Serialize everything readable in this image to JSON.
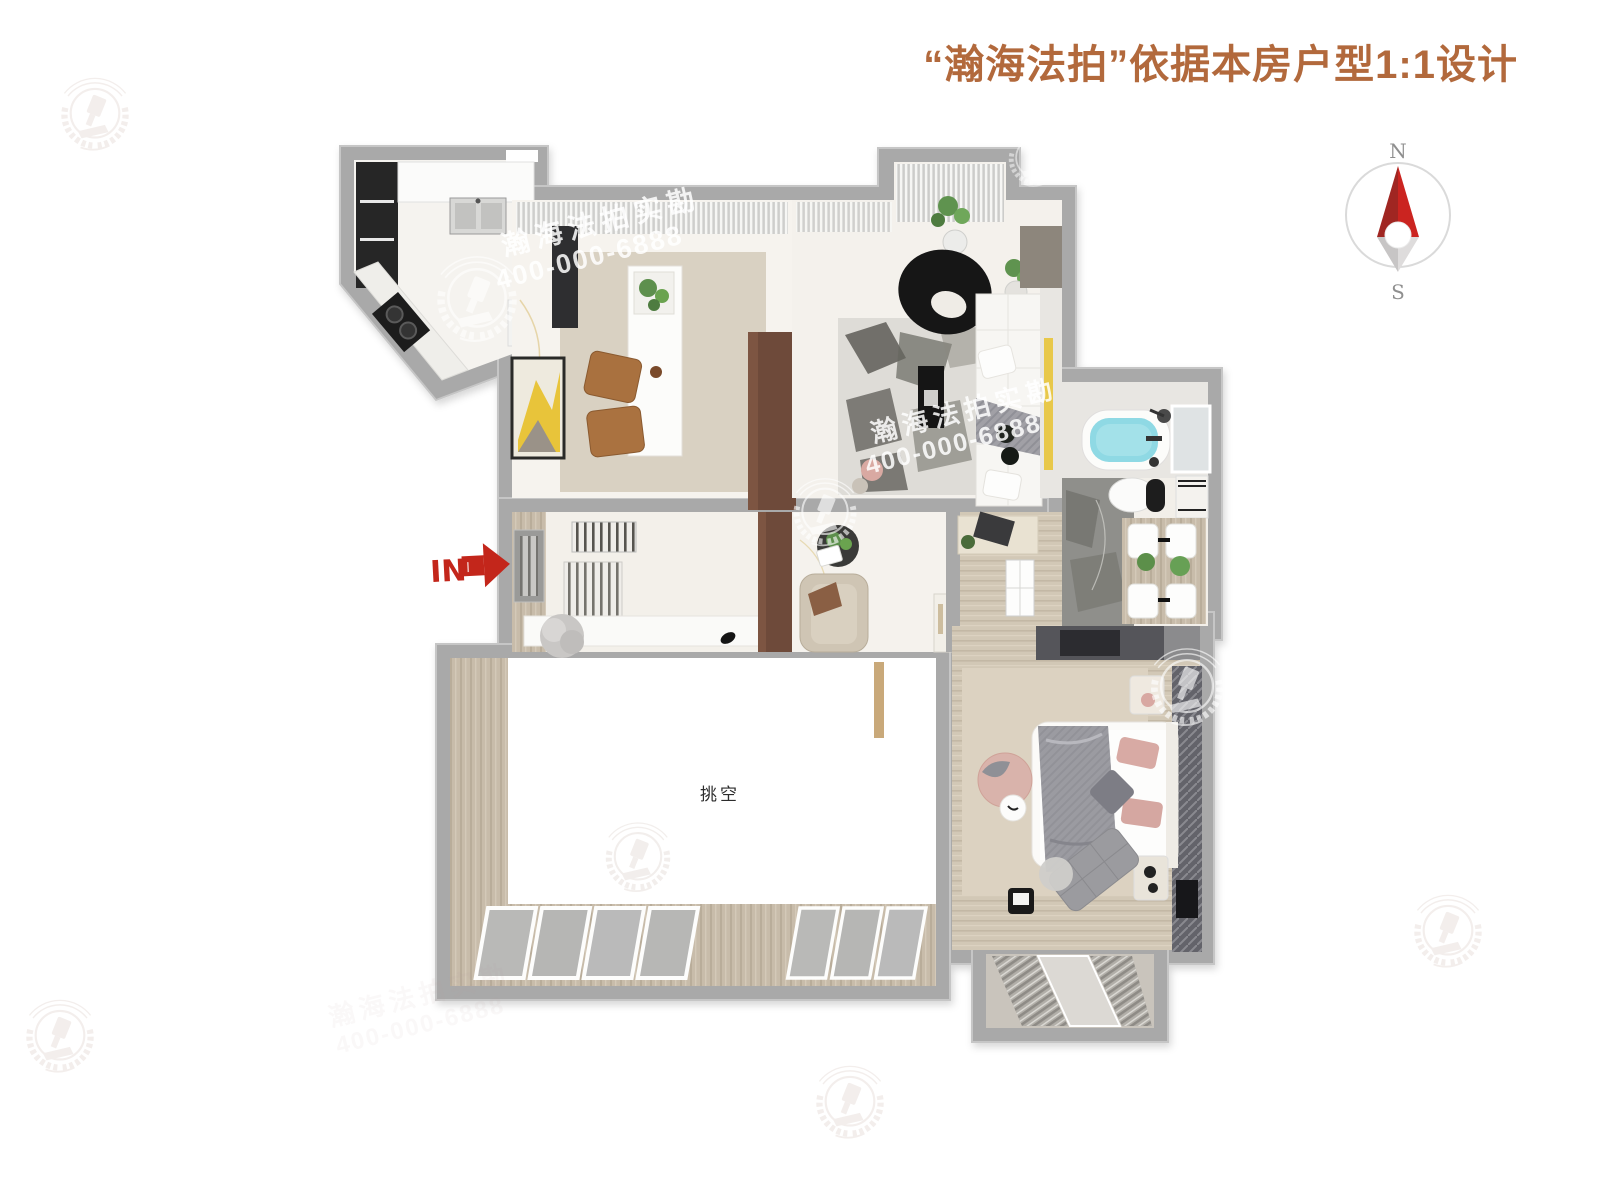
{
  "header": {
    "title": "“瀚海法拍”依据本房户型1:1设计",
    "title_color": "#b2693c"
  },
  "compass": {
    "north_label": "N",
    "south_label": "S",
    "needle_red": "#c9201d",
    "needle_dark_red": "#a02622"
  },
  "entry": {
    "label": "IN",
    "arrow_color": "#c3261b"
  },
  "rooms": {
    "void_label": "挑空"
  },
  "watermark": {
    "brand": "瀚海法拍实勘",
    "phone": "400-000-6888"
  },
  "colors": {
    "wall": "#a9a9a9",
    "floor_marble": "#f5f3ef",
    "floor_wood": "#c8bcaa",
    "carpet_beige": "#dcd2c1",
    "rug_beige": "#d9d1c2",
    "dark_marble": "#8f8f8b",
    "tub_water": "#8fd9e4",
    "accent_yellow": "#e8c84a",
    "cabinet_brown": "#6e4a3a",
    "blanket_gray": "#9a9aa0",
    "pillow_pink": "#d8aaa4"
  }
}
